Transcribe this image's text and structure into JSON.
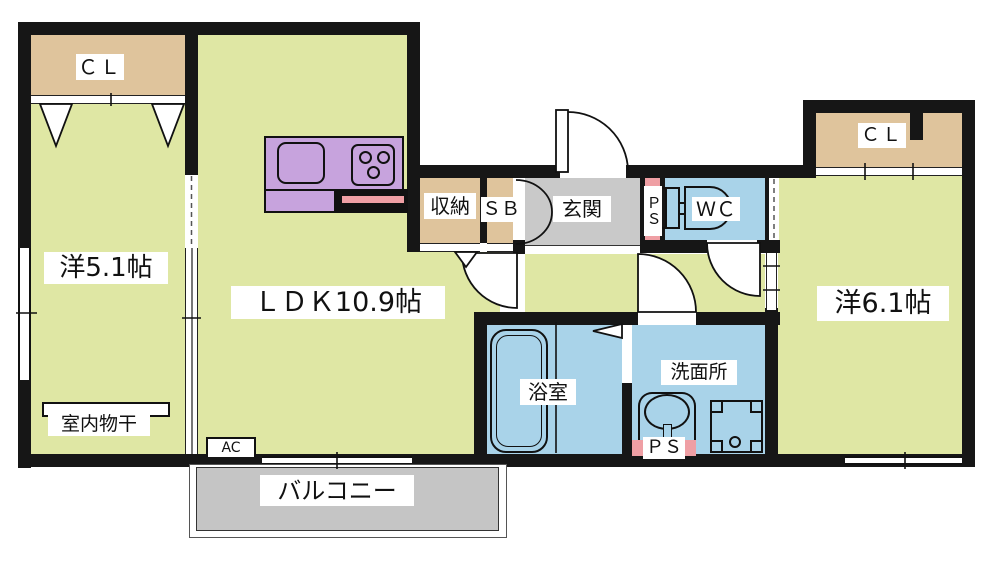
{
  "title": "apartment floor plan",
  "colors": {
    "wall": "#161616",
    "room": "#dfe7a4",
    "closet": "#dfc49c",
    "wet": "#a9d3e9",
    "entrance_floor": "#c9c9c9",
    "balcony": "#c5c5c5",
    "kitchen_counter": "#c7a3dd",
    "accent_pink": "#ef9fa4",
    "label_bg": "#ffffff"
  },
  "labels": {
    "cl_left": "ＣＬ",
    "western_5_1": "洋5.1帖",
    "ldk": "ＬＤＫ10.9帖",
    "storage": "収納",
    "shoe_box": "ＳＢ",
    "entrance": "玄関",
    "ps_top": "ＰＳ",
    "wc": "ＷＣ",
    "cl_right": "ＣＬ",
    "western_6_1": "洋6.1帖",
    "bath": "浴室",
    "washroom": "洗面所",
    "ps_bottom": "ＰＳ",
    "balcony": "バルコニー",
    "indoor_drying": "室内物干",
    "ac": "AC"
  }
}
